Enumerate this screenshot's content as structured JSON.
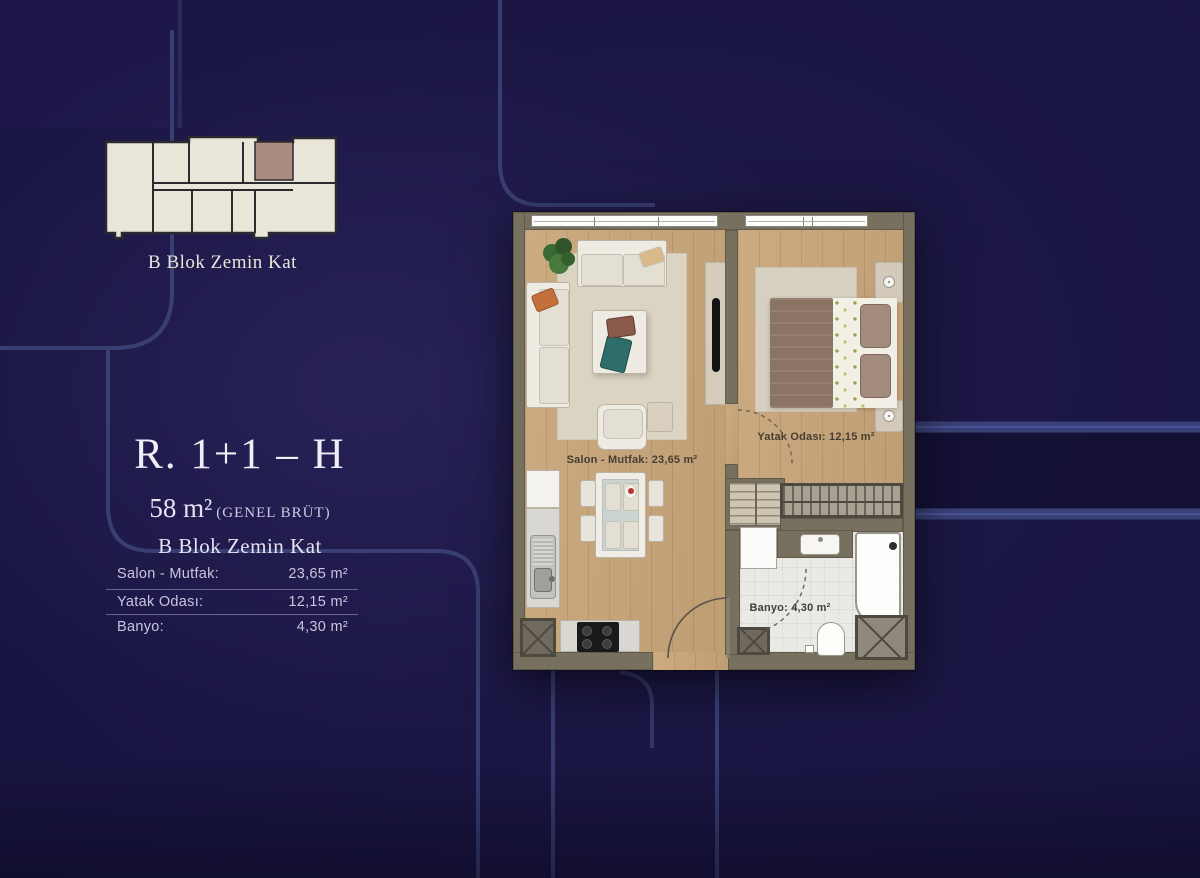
{
  "key_plan": {
    "caption": "B Blok Zemin Kat"
  },
  "unit_info": {
    "type_code": "R. 1+1 – H",
    "gross_area": "58 m²",
    "gross_area_note": "(GENEL BRÜT)",
    "block_floor": "B Blok Zemin Kat"
  },
  "area_table": {
    "rows": [
      {
        "label": "Salon - Mutfak:",
        "value": "23,65 m²"
      },
      {
        "label": "Yatak Odası:",
        "value": "12,15 m²"
      },
      {
        "label": "Banyo:",
        "value": "4,30 m²"
      }
    ]
  },
  "floor_plan": {
    "room_labels": {
      "living": "Salon - Mutfak: 23,65 m²",
      "bedroom": "Yatak Odası: 12,15 m²",
      "bathroom": "Banyo: 4,30 m²"
    }
  },
  "colors": {
    "background": "#181441",
    "trace_line": "#3d4378",
    "wall": "#77705f",
    "wood_floor": "#c9a67a",
    "key_plan_fill": "#e9e5d9",
    "highlight_unit": "#a98e80",
    "title_text": "#efedf6"
  }
}
